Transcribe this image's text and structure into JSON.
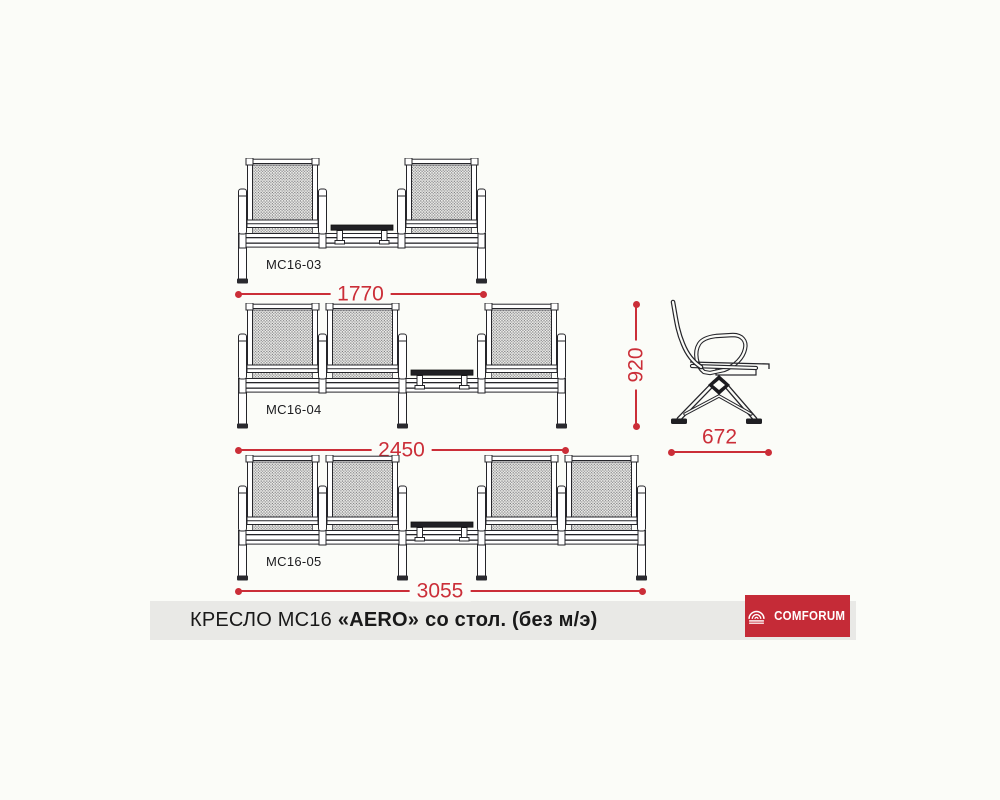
{
  "page": {
    "background": "#fbfcf8"
  },
  "drawing": {
    "benches": [
      {
        "model": "MC16-03",
        "groups": [
          1,
          1
        ],
        "legs": [
          0,
          3
        ],
        "width_dim": "1770"
      },
      {
        "model": "MC16-04",
        "groups": [
          2,
          1
        ],
        "legs": [
          0,
          2,
          4
        ],
        "width_dim": "2450"
      },
      {
        "model": "MC16-05",
        "groups": [
          2,
          2
        ],
        "legs": [
          0,
          2,
          3,
          5
        ],
        "width_dim": "3055"
      }
    ],
    "side_view": {
      "height_dim": "920",
      "depth_dim": "672"
    },
    "dim_color": "#cb2e38",
    "line_color": "#25252a"
  },
  "footer": {
    "title_prefix": "КРЕСЛО МС16",
    "title_model": "«AERO»",
    "title_suffix": "со стол. (без м/э)",
    "bar_color": "#e9e9e6",
    "logo": {
      "text": "COMFORUM",
      "icon": "awning-icon",
      "color": "#c52b37",
      "text_color": "#ffffff"
    }
  }
}
